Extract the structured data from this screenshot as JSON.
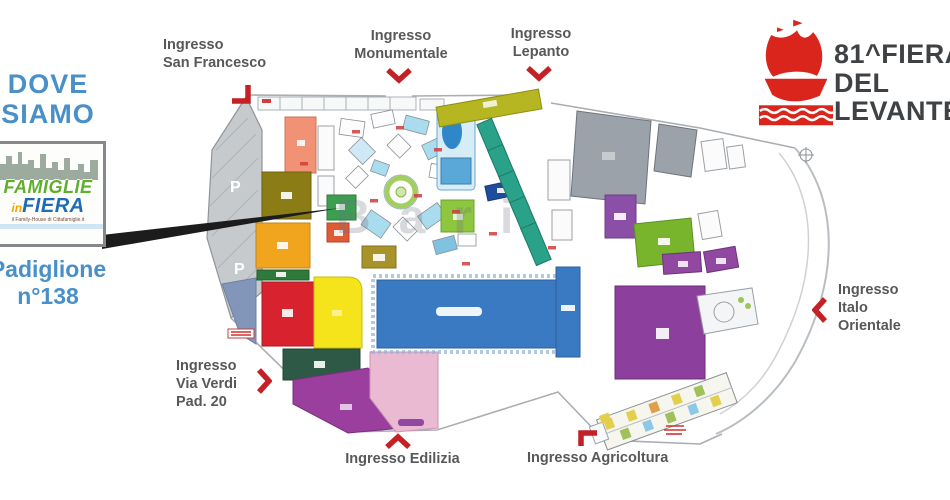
{
  "colors": {
    "accent_blue": "#4a90c8",
    "arrow_red": "#c42127",
    "brand_red": "#d9251c",
    "brand_text_gray": "#3f4245",
    "entrance_label_gray": "#56585a"
  },
  "left_panel": {
    "heading": "DOVE\nSIAMO",
    "logo": {
      "famiglie": "FAMIGLIE",
      "in": "in",
      "fiera": "FIERA",
      "tagline": "il Family-House di Cittafamiglie.it",
      "icon": "city-skyline-icon"
    },
    "pavilion": "Padiglione\nn°138"
  },
  "brand": {
    "line1": "81^FIERA",
    "line2": "DEL",
    "line3": "LEVANTE",
    "icon": "caravel-ship-icon"
  },
  "entrances": [
    {
      "id": "san-francesco",
      "label": "Ingresso\nSan Francesco",
      "arrow": "corner-down-left"
    },
    {
      "id": "monumentale",
      "label": "Ingresso\nMonumentale",
      "arrow": "chevron-down"
    },
    {
      "id": "lepanto",
      "label": "Ingresso\nLepanto",
      "arrow": "chevron-down"
    },
    {
      "id": "italo-orientale",
      "label": "Ingresso\nItalo\nOrientale",
      "arrow": "chevron-left"
    },
    {
      "id": "via-verdi",
      "label": "Ingresso\nVia Verdi\nPad. 20",
      "arrow": "chevron-right"
    },
    {
      "id": "edilizia",
      "label": "Ingresso Edilizia",
      "arrow": "chevron-up"
    },
    {
      "id": "agricoltura",
      "label": "Ingresso Agricoltura",
      "arrow": "corner-up-left"
    }
  ],
  "map": {
    "watermark": "Bari",
    "parking_label": "P"
  }
}
